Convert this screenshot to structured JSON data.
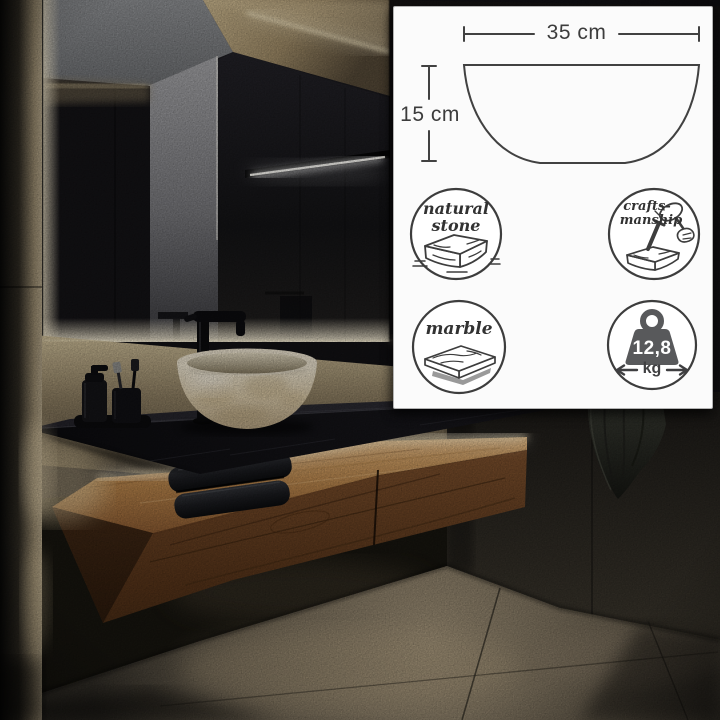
{
  "meta": {
    "type": "product photo with specification overlay",
    "subject": "round natural stone vessel washbasin on a dark floating vanity"
  },
  "spec_panel": {
    "diagram": {
      "shape": "washbasin side profile",
      "width_label": "35 cm",
      "height_label": "15 cm"
    },
    "badges": [
      {
        "id": "natural-stone",
        "line1": "natural",
        "line2": "stone"
      },
      {
        "id": "craftsmanship",
        "line1": "crafts-",
        "line2": "manship"
      },
      {
        "id": "marble",
        "line1": "marble"
      },
      {
        "id": "weight",
        "value": "12,8",
        "unit": "kg"
      }
    ],
    "colors": {
      "panel_bg": "#fbfbfb",
      "line": "#3d3d3d",
      "weight_fill": "#58595b"
    }
  },
  "scene": {
    "objects": [
      "backlit-mirror",
      "stone-vessel-basin",
      "black-faucet",
      "soap-dispenser",
      "toothbrush-cup",
      "folded-towels",
      "walnut-floating-vanity",
      "black-stone-countertop",
      "hanging-towel",
      "slate-tile-walls",
      "stone-floor"
    ],
    "palette": {
      "wall_dark": "#17161a",
      "wood": "#7a4e2c",
      "led_glow": "#ffe9b8",
      "basin": "#e7dcc4",
      "floor": "#7d7260"
    }
  }
}
